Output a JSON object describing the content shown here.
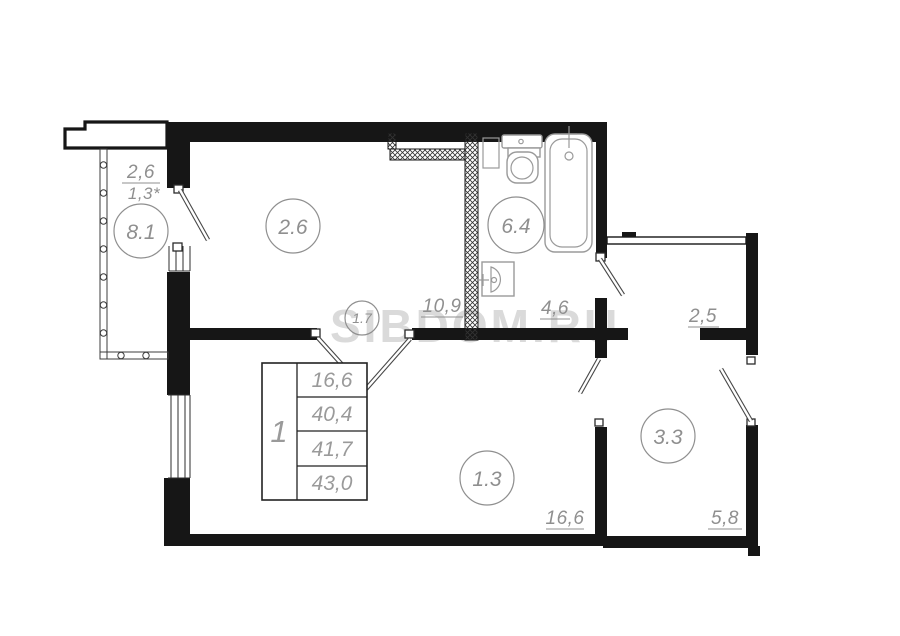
{
  "watermark": "SIBDOM.RU",
  "balcony": {
    "area": "2,6",
    "area_reduced": "1,3*",
    "circle": "8.1"
  },
  "room_top": {
    "circle": "2.6",
    "area": "10,9"
  },
  "bathroom": {
    "circle": "6.4",
    "area": "4,6"
  },
  "hallway": {
    "circle": "1.7"
  },
  "corridor": {
    "area": "2,5"
  },
  "living_room": {
    "circle": "1.3",
    "area": "16,6"
  },
  "entry": {
    "circle": "3.3",
    "area": "5,8"
  },
  "summary_table": {
    "rooms": "1",
    "rows": [
      "16,6",
      "40,4",
      "41,7",
      "43,0"
    ]
  }
}
